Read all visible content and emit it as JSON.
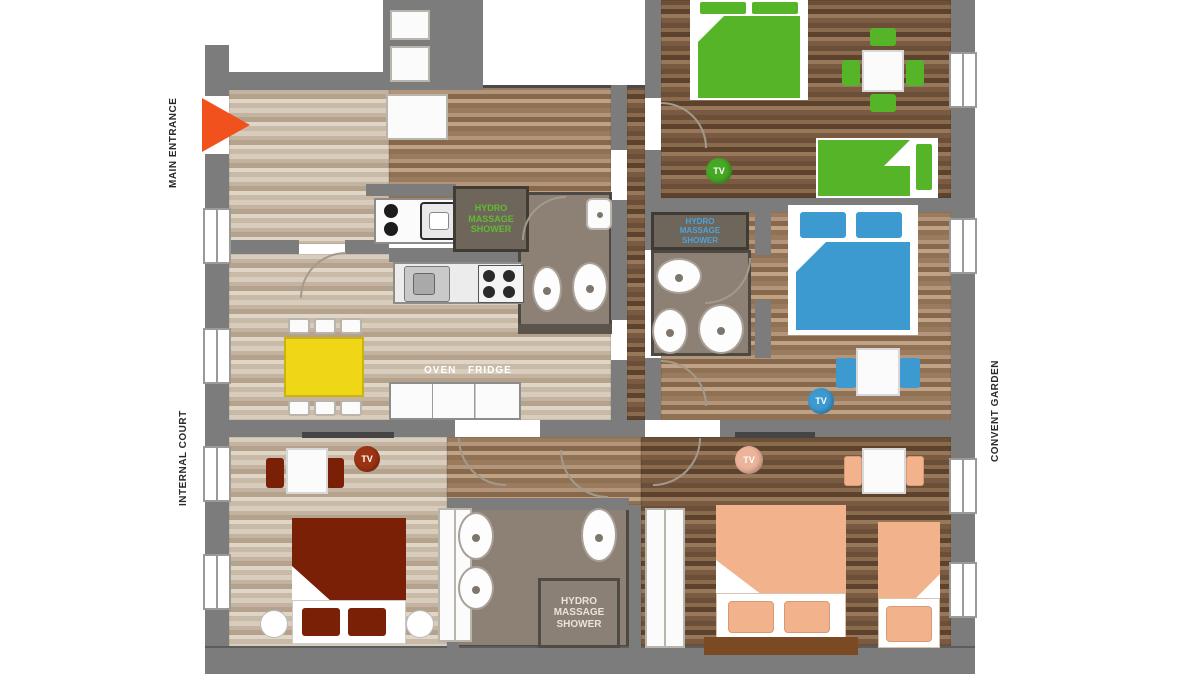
{
  "plan": {
    "side_labels": {
      "main_entrance": "MAIN ENTRANCE",
      "internal_court": "INTERNAL COURT",
      "convent_garden": "CONVENT GARDEN"
    },
    "kitchen_labels": {
      "oven": "OVEN",
      "fridge": "FRIDGE"
    },
    "shower_labels": {
      "apartment1": "HYDRO MASSAGE SHOWER",
      "apartment2": "HYDRO MASSAGE SHOWER",
      "apartment3": "HYDRO MASSAGE SHOWER"
    },
    "tv_markers": [
      {
        "room": "green-bedroom",
        "label": "TV"
      },
      {
        "room": "blue-bedroom",
        "label": "TV"
      },
      {
        "room": "red-bedroom",
        "label": "TV"
      },
      {
        "room": "peach-bedroom",
        "label": "TV"
      }
    ],
    "colors": {
      "wall": "#7c7c7c",
      "entrance_arrow": "#f1511d",
      "green": "#55b427",
      "blue": "#3d9ad1",
      "dark_red": "#7a2007",
      "peach": "#f2b28c",
      "yellow": "#efd616",
      "bench_brown": "#7c4a22",
      "bath_floor": "#8d8175",
      "shower_box": "#6e655b",
      "tv_green": "#46a824",
      "tv_blue": "#3d9ad1",
      "tv_red": "#9c3413",
      "tv_peach": "#edb49c",
      "shower_text_green": "#62bb33",
      "shower_text_blue": "#4aa4dc",
      "shower_text_light": "#ece2d8"
    }
  }
}
